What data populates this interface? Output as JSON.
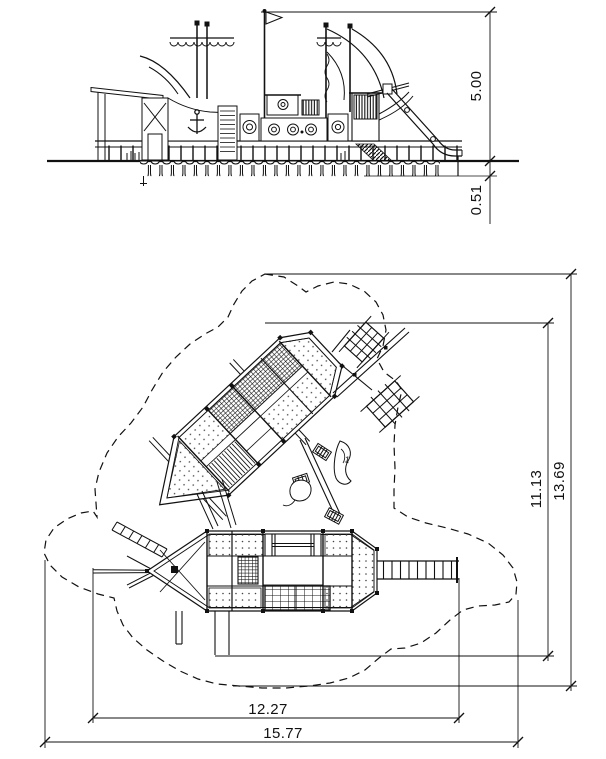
{
  "drawing": {
    "background_color": "#ffffff",
    "line_color": "#111111",
    "elevation": {
      "height_dim": "5.00",
      "depth_dim": "0.51"
    },
    "plan": {
      "structure_height_dim": "11.13",
      "safety_zone_height_dim": "13.69",
      "structure_width_dim": "12.27",
      "safety_zone_width_dim": "15.77",
      "item_marker": "1"
    }
  }
}
